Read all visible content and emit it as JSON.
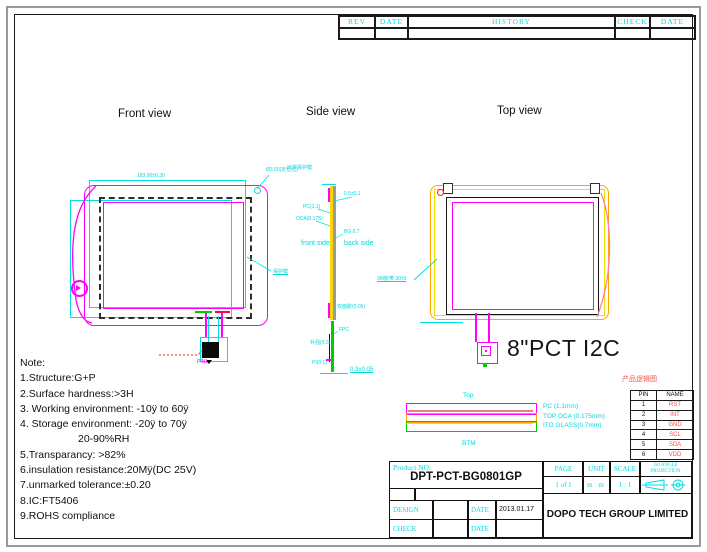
{
  "colors": {
    "cyan": "#00e0e0",
    "magenta": "#ff00ff",
    "orange": "#ffa500",
    "yellow": "#f5e000",
    "green": "#00cc00",
    "red": "#ff2222",
    "pink": "#ff7bac",
    "frame_gray": "#9a9a9a"
  },
  "revision_table": {
    "headers": [
      "REV",
      "DATE",
      "HISTORY",
      "CHECK",
      "DATE"
    ]
  },
  "views": {
    "front": {
      "title": "Front view",
      "dim_top": "183.00±0.30",
      "hole_label": "Ø3.50(定位孔)",
      "film_label": "保护膜",
      "pin1_label": "PIN1"
    },
    "side": {
      "title": "Side view",
      "front_side": "front side",
      "back_side": "back side",
      "top_gap": "0.5±0.1",
      "pc": "PC(1.1)",
      "oca": "OCA(0.175)",
      "glass": "BG 0.7",
      "adhesive": "双面胶(0.05)",
      "fpc": "FPC",
      "stiffener": "补强(0.3)",
      "film": "PI(0.1)",
      "bottom_dim": "0.3±0.05",
      "ship_film": "出货保护膜",
      "tape_label": "3M胶带 30±5"
    },
    "top": {
      "title": "Top view",
      "product_text": "8\"PCT I2C"
    }
  },
  "stack": {
    "top_label": "Top",
    "btm_label": "BTM",
    "layers": [
      "PC (1.1mm)",
      "TOP OCA (0.175mm)",
      "ITO GLASS(0.7mm)"
    ]
  },
  "pin_table": {
    "caption": "产品逻辑图",
    "headers": [
      "PIN",
      "NAME"
    ],
    "rows": [
      [
        "1",
        "RST"
      ],
      [
        "2",
        "INT"
      ],
      [
        "3",
        "GND"
      ],
      [
        "4",
        "SCL"
      ],
      [
        "5",
        "SDA"
      ],
      [
        "6",
        "VDD"
      ]
    ]
  },
  "notes": {
    "lines": [
      "Note:",
      "1.Structure:G+P",
      "2.Surface hardness:>3H",
      "3. Working environment: -10ÿ to 60ÿ",
      "4. Storage environment: -20ÿ to 70ÿ",
      "20-90%RH",
      "5.Transparancy: >82%",
      "6.insulation resistance:20Mÿ(DC 25V)",
      "7.unmarked tolerance:±0.20",
      "8.IC:FT5406",
      "9.ROHS compliance"
    ]
  },
  "title_block": {
    "product_label": "Product NO:",
    "product_no": "DPT-PCT-BG0801GP",
    "page_label": "PAGE",
    "page_value": "1 of 1",
    "unit_label": "UNIT",
    "unit_value": "m m",
    "scale_label": "SCALE",
    "scale_value": "1 : 1",
    "projection_line1": "3rd ANGLE",
    "projection_line2": "PROJECTION",
    "design_label": "DESIGN",
    "design_date_label": "DATE",
    "design_date": "2013.01.17",
    "check_label": "CHECK",
    "check_date_label": "DATE",
    "company": "DOPO TECH GROUP LIMITED"
  }
}
